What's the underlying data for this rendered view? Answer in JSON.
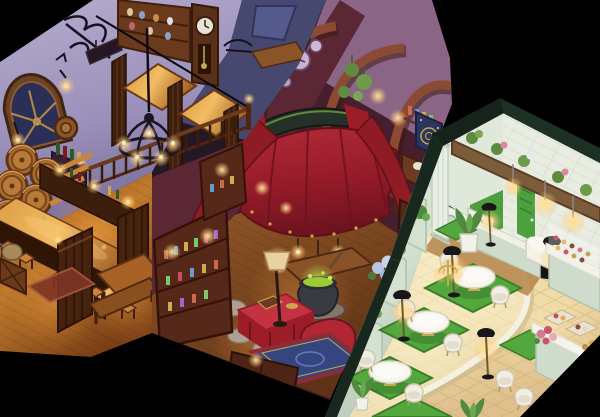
{
  "scene": {
    "title": "Isometric cutaway artwork of three rooms",
    "style": "hand-painted isometric game rooms floating on a black background",
    "background": "#000000",
    "rooms": [
      {
        "name": "Tavern",
        "mood": "warm candlelit pub at night with purple walls and glowing wood",
        "objects": [
          "arched round window",
          "wrought-iron wall sign",
          "wall sconce lamps",
          "stacked wine barrels",
          "wine bottle shelf",
          "hanging barrel-lid shield",
          "jar display cabinet",
          "grandfather clock",
          "iron wall rack",
          "mezzanine booth tables",
          "slatted booth partitions",
          "turned-post railing",
          "staircase",
          "iron candle chandelier",
          "back bar with lanterns",
          "L-shaped bar counter",
          "bar stools",
          "slatted wooden gates",
          "dining table with bench",
          "small red rug",
          "storage crate and sack"
        ],
        "palette": {
          "wall": "#aba1c8",
          "wall_shadow": "#786f9f",
          "back_wall": "#46486f",
          "floor": "#b06a28",
          "wood_dark": "#3f2010",
          "counter_glow": "#e8aa52",
          "lamp_glow": "#ffd98e",
          "barrel": "#a86c2c",
          "window_glass": "#2b2f58"
        }
      },
      {
        "name": "Magic shop",
        "mood": "cluttered apothecary draped in red cloth and lit by lanterns",
        "objects": [
          "three wooden arch ribs",
          "purple wall clocks",
          "hanging plants",
          "celestial chart poster",
          "apothecary desk with mortar",
          "balustrade ledge",
          "red canopy with green-lit frame",
          "red drape tails",
          "hanging lanterns",
          "trinket counter",
          "bubbling green cauldron",
          "stone flagstone path",
          "red draped table with chest",
          "red armchair with black cat",
          "blue persian rug",
          "shaded floor lamp",
          "hydrangea flower stand",
          "potion hutch with bottles",
          "lower drawer cabinet",
          "potion shelf tower"
        ],
        "palette": {
          "wall_left": "#5c2734",
          "wall_back": "#8a6585",
          "arch_wood": "#8a4a33",
          "canopy": "#a8202d",
          "canopy_dark": "#6f1320",
          "floor": "#8a4f24",
          "stone": "#b0a093",
          "rug": "#35457f",
          "armchair": "#b02733",
          "cauldron_glow": "#9ccb33",
          "lamp_glow": "#ffcf80"
        }
      },
      {
        "name": "Café",
        "mood": "bright pastel tea room with green rugs and warm lamps",
        "objects": [
          "dark green roof trim",
          "white brick back wall",
          "wooden beam with flower pots",
          "green door",
          "kitchen pass counter",
          "white appliance",
          "white bench seat",
          "hanging pendant bulbs",
          "paneled mint wall",
          "column pilaster",
          "hanging plant",
          "round white pedestal tables",
          "white tub chairs",
          "green area rugs",
          "black dome floor lamps",
          "gold candelabra lamp",
          "curved white platform edge",
          "wood walkway strip",
          "glass pastry display cases",
          "pastry trays",
          "flower bouquet",
          "potted plants"
        ],
        "palette": {
          "roof": "#1d3024",
          "wall": "#dce8d8",
          "brick": "#e9ece1",
          "door": "#4da03e",
          "beam": "#7c5c3a",
          "floor": "#f2e2b8",
          "rug": "#53a73d",
          "table": "#f8f5ed",
          "chair": "#f1eee4",
          "lamp_shade": "#17171a",
          "glow": "#ffe9a8",
          "counter": "#cfdccb"
        }
      }
    ]
  }
}
